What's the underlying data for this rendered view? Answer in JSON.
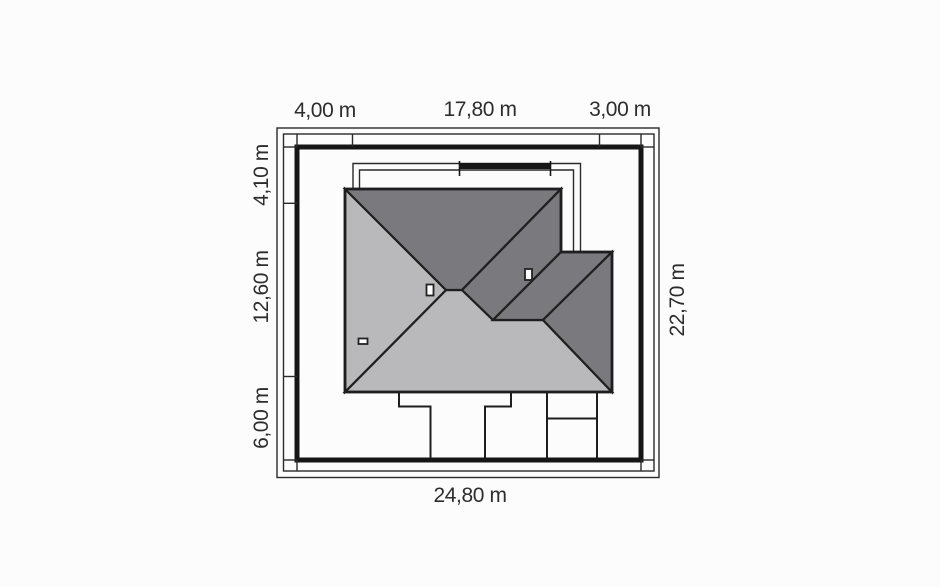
{
  "title": "House plot site plan (roof view)",
  "canvas": {
    "width": 940,
    "height": 587,
    "background": "#fcfcfc"
  },
  "colors": {
    "roof_dark": "#7a7a7e",
    "roof_light": "#b9b9bb",
    "line": "#1e1e1e",
    "boundary": "#161616",
    "text": "#2d2d2d"
  },
  "dimensions": {
    "top": [
      {
        "label": "4,00 m"
      },
      {
        "label": "17,80 m"
      },
      {
        "label": "3,00 m"
      }
    ],
    "left": [
      {
        "label": "4,10 m"
      },
      {
        "label": "12,60 m"
      },
      {
        "label": "6,00 m"
      }
    ],
    "right": [
      {
        "label": "22,70 m"
      }
    ],
    "bottom": [
      {
        "label": "24,80 m"
      }
    ],
    "plot_width_m": 24.8,
    "plot_depth_m": 22.7
  },
  "shapes": [
    {
      "name": "outer-frame",
      "type": "rect",
      "x": 277,
      "y": 128,
      "w": 382,
      "h": 349.5,
      "fill": "none",
      "stroke": "#2a2a2a",
      "sw": 1.4
    },
    {
      "name": "outer-frame-inner",
      "type": "rect",
      "x": 283.5,
      "y": 134,
      "w": 370.5,
      "h": 337,
      "fill": "none",
      "stroke": "#2a2a2a",
      "sw": 1.4
    },
    {
      "name": "plot-boundary",
      "type": "rect",
      "x": 297,
      "y": 147,
      "w": 344,
      "h": 313,
      "fill": "none",
      "stroke": "#161616",
      "sw": 5
    },
    {
      "name": "dim-tick-top-corner-left",
      "type": "line",
      "x1": 297,
      "y1": 134,
      "x2": 297,
      "y2": 147,
      "stroke": "#2a2a2a",
      "sw": 1.4
    },
    {
      "name": "dim-tick-top-1",
      "type": "line",
      "x1": 352.5,
      "y1": 134,
      "x2": 352.5,
      "y2": 147,
      "stroke": "#2a2a2a",
      "sw": 1.4
    },
    {
      "name": "dim-tick-top-2",
      "type": "line",
      "x1": 599.5,
      "y1": 134,
      "x2": 599.5,
      "y2": 147,
      "stroke": "#2a2a2a",
      "sw": 1.4
    },
    {
      "name": "dim-tick-top-corner-right",
      "type": "line",
      "x1": 641,
      "y1": 134,
      "x2": 641,
      "y2": 147,
      "stroke": "#2a2a2a",
      "sw": 1.4
    },
    {
      "name": "dim-tick-left-corner-top",
      "type": "line",
      "x1": 283.5,
      "y1": 147,
      "x2": 297,
      "y2": 147,
      "stroke": "#2a2a2a",
      "sw": 1.4
    },
    {
      "name": "dim-tick-left-1",
      "type": "line",
      "x1": 283.5,
      "y1": 203.3,
      "x2": 297,
      "y2": 203.3,
      "stroke": "#2a2a2a",
      "sw": 1.4
    },
    {
      "name": "dim-tick-left-2",
      "type": "line",
      "x1": 283.5,
      "y1": 376.5,
      "x2": 297,
      "y2": 376.5,
      "stroke": "#2a2a2a",
      "sw": 1.4
    },
    {
      "name": "dim-tick-left-corner-bottom",
      "type": "line",
      "x1": 283.5,
      "y1": 460,
      "x2": 297,
      "y2": 460,
      "stroke": "#2a2a2a",
      "sw": 1.4
    },
    {
      "name": "dim-tick-right-corner-top",
      "type": "line",
      "x1": 641,
      "y1": 147,
      "x2": 654,
      "y2": 147,
      "stroke": "#2a2a2a",
      "sw": 1.4
    },
    {
      "name": "dim-tick-right-corner-bottom",
      "type": "line",
      "x1": 641,
      "y1": 460,
      "x2": 654,
      "y2": 460,
      "stroke": "#2a2a2a",
      "sw": 1.4
    },
    {
      "name": "dim-tick-bottom-corner-left",
      "type": "line",
      "x1": 297,
      "y1": 460,
      "x2": 297,
      "y2": 471,
      "stroke": "#2a2a2a",
      "sw": 1.4
    },
    {
      "name": "dim-tick-bottom-corner-right",
      "type": "line",
      "x1": 641,
      "y1": 460,
      "x2": 641,
      "y2": 471,
      "stroke": "#2a2a2a",
      "sw": 1.4
    },
    {
      "name": "wall-outline-outer",
      "type": "polyline",
      "points": "353,189 353,163.5 580.5,163.5 580.5,252",
      "fill": "none",
      "stroke": "#2a2a2a",
      "sw": 1.4
    },
    {
      "name": "wall-outline-inner",
      "type": "polyline",
      "points": "359.5,189 359.5,170 573.5,170 573.5,252",
      "fill": "none",
      "stroke": "#2a2a2a",
      "sw": 1.4
    },
    {
      "name": "terrace-wall",
      "type": "line",
      "x1": 459,
      "y1": 166,
      "x2": 551,
      "y2": 166,
      "stroke": "#161616",
      "sw": 6
    },
    {
      "name": "terrace-wall-cap-left",
      "type": "line",
      "x1": 459.5,
      "y1": 161,
      "x2": 459.5,
      "y2": 176,
      "stroke": "#161616",
      "sw": 1.6
    },
    {
      "name": "terrace-wall-cap-right",
      "type": "line",
      "x1": 550.5,
      "y1": 161,
      "x2": 550.5,
      "y2": 176,
      "stroke": "#161616",
      "sw": 1.6
    },
    {
      "name": "roof-face-south",
      "type": "polygon",
      "points": "345,392 446,290 462,290 493,320 543,320 612,392",
      "fill": "#b9b9bb",
      "stroke": "#1f1f1f",
      "sw": 2.2
    },
    {
      "name": "roof-face-west",
      "type": "polygon",
      "points": "345,189 446,290 345,392",
      "fill": "#b9b9bb",
      "stroke": "#1f1f1f",
      "sw": 2.2
    },
    {
      "name": "roof-face-north",
      "type": "polygon",
      "points": "345,189 561,189 462,290 446,290",
      "fill": "#7a7a7e",
      "stroke": "#1f1f1f",
      "sw": 2.2
    },
    {
      "name": "roof-face-east",
      "type": "polygon",
      "points": "561,189 561,252 493,320 462,290",
      "fill": "#7a7a7e",
      "stroke": "#1f1f1f",
      "sw": 2.2
    },
    {
      "name": "roof-wing-face-north",
      "type": "polygon",
      "points": "561,252 612,252 543,320 493,320",
      "fill": "#7a7a7e",
      "stroke": "#1f1f1f",
      "sw": 2.2
    },
    {
      "name": "roof-wing-face-east",
      "type": "polygon",
      "points": "612,252 612,392 543,320",
      "fill": "#7a7a7e",
      "stroke": "#1f1f1f",
      "sw": 2.2
    },
    {
      "name": "roof-outline",
      "type": "polygon",
      "points": "345,189 561,189 561,252 612,252 612,392 345,392",
      "fill": "none",
      "stroke": "#1e1e1e",
      "sw": 2.8
    },
    {
      "name": "chimney-1",
      "type": "rect",
      "x": 426.5,
      "y": 284.5,
      "w": 7,
      "h": 11,
      "fill": "#ffffff",
      "stroke": "#222222",
      "sw": 1.8
    },
    {
      "name": "chimney-2",
      "type": "rect",
      "x": 525,
      "y": 269,
      "w": 7,
      "h": 11,
      "fill": "#ffffff",
      "stroke": "#222222",
      "sw": 1.8
    },
    {
      "name": "chimney-3",
      "type": "rect",
      "x": 358.5,
      "y": 338.5,
      "w": 9,
      "h": 5.5,
      "fill": "#ffffff",
      "stroke": "#222222",
      "sw": 1.8
    },
    {
      "name": "walkway-left-edge",
      "type": "polyline",
      "points": "399,392 399,406.5 430.5,406.5 430.5,458",
      "fill": "none",
      "stroke": "#1e1e1e",
      "sw": 2
    },
    {
      "name": "walkway-right-edge",
      "type": "polyline",
      "points": "511,392 511,406.5 485,406.5 485,458",
      "fill": "none",
      "stroke": "#1e1e1e",
      "sw": 2
    },
    {
      "name": "driveway-left-edge",
      "type": "line",
      "x1": 547,
      "y1": 392,
      "x2": 547,
      "y2": 458,
      "stroke": "#1e1e1e",
      "sw": 2
    },
    {
      "name": "driveway-right-edge",
      "type": "line",
      "x1": 597,
      "y1": 392,
      "x2": 597,
      "y2": 458,
      "stroke": "#1e1e1e",
      "sw": 2
    },
    {
      "name": "driveway-divider",
      "type": "line",
      "x1": 547,
      "y1": 418.5,
      "x2": 597,
      "y2": 418.5,
      "stroke": "#1e1e1e",
      "sw": 2
    }
  ]
}
